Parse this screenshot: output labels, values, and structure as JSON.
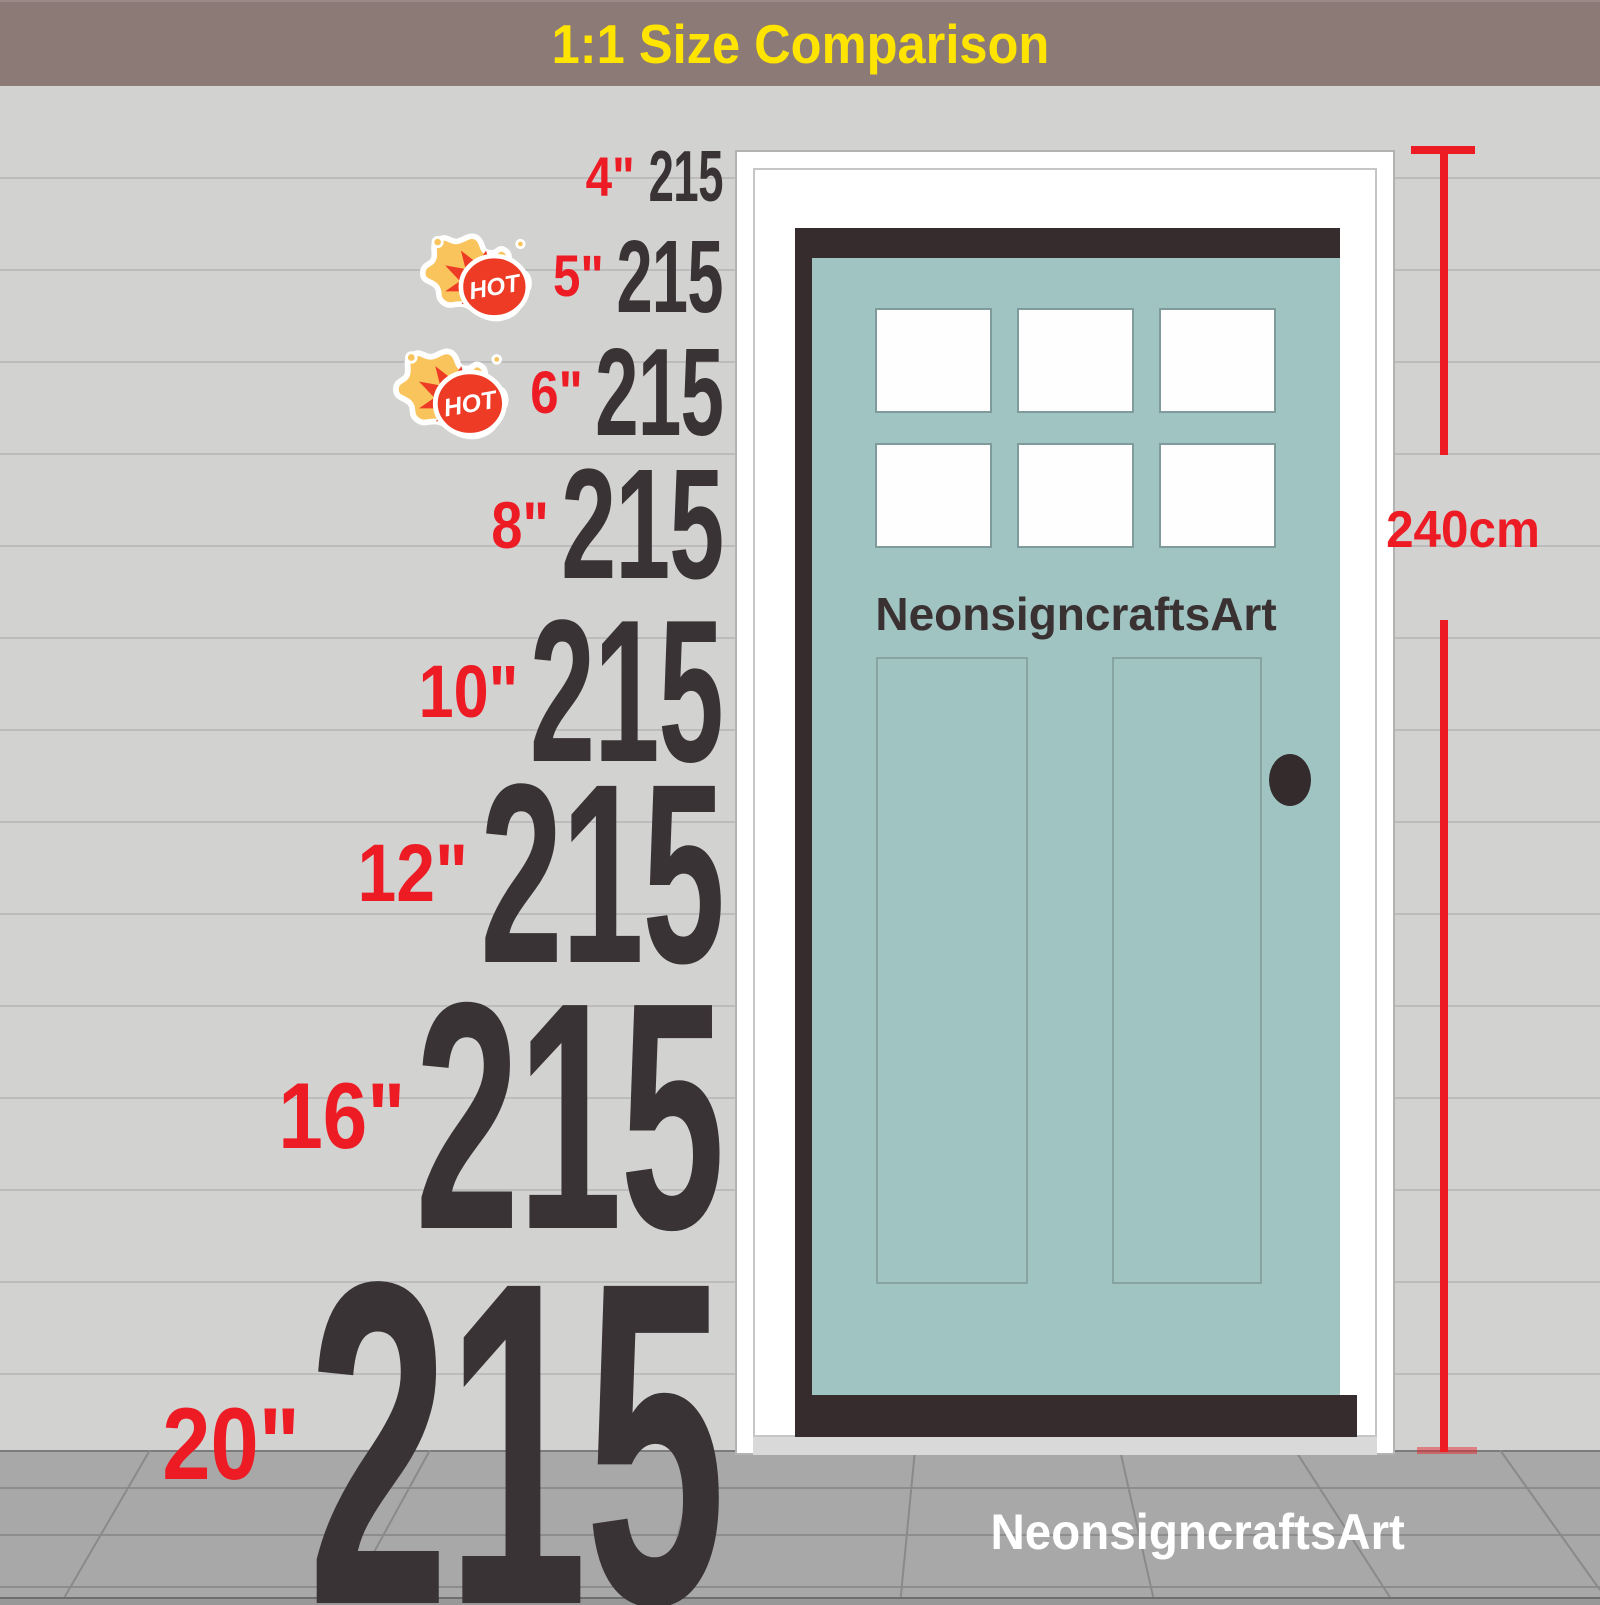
{
  "banner": {
    "title": "1:1 Size Comparison"
  },
  "size_rows": [
    {
      "label": "4\"",
      "value": "215",
      "hot": false
    },
    {
      "label": "5\"",
      "value": "215",
      "hot": true
    },
    {
      "label": "6\"",
      "value": "215",
      "hot": true
    },
    {
      "label": "8\"",
      "value": "215",
      "hot": false
    },
    {
      "label": "10\"",
      "value": "215",
      "hot": false
    },
    {
      "label": "12\"",
      "value": "215",
      "hot": false
    },
    {
      "label": "16\"",
      "value": "215",
      "hot": false
    },
    {
      "label": "20\"",
      "value": "215",
      "hot": false
    }
  ],
  "hot_badge_text": "HOT",
  "door": {
    "brand": "NeonsigncraftsArt",
    "height_label": "240cm"
  },
  "footer_brand": "NeonsigncraftsArt",
  "colors": {
    "banner_bg": "#8c7a77",
    "banner_text": "#ffe400",
    "wall": "#d2d2d1",
    "wall_line": "#bcbcbc",
    "accent_red": "#ed1c24",
    "number": "#3a3335",
    "door_teal": "#a0c4c2",
    "door_dark": "#362c2d",
    "frame_white": "#ffffff",
    "floor": "#a8a8a8",
    "floor_line": "#8d8d8d",
    "hot_red": "#ee3b25",
    "hot_yellow": "#f9c45c"
  }
}
